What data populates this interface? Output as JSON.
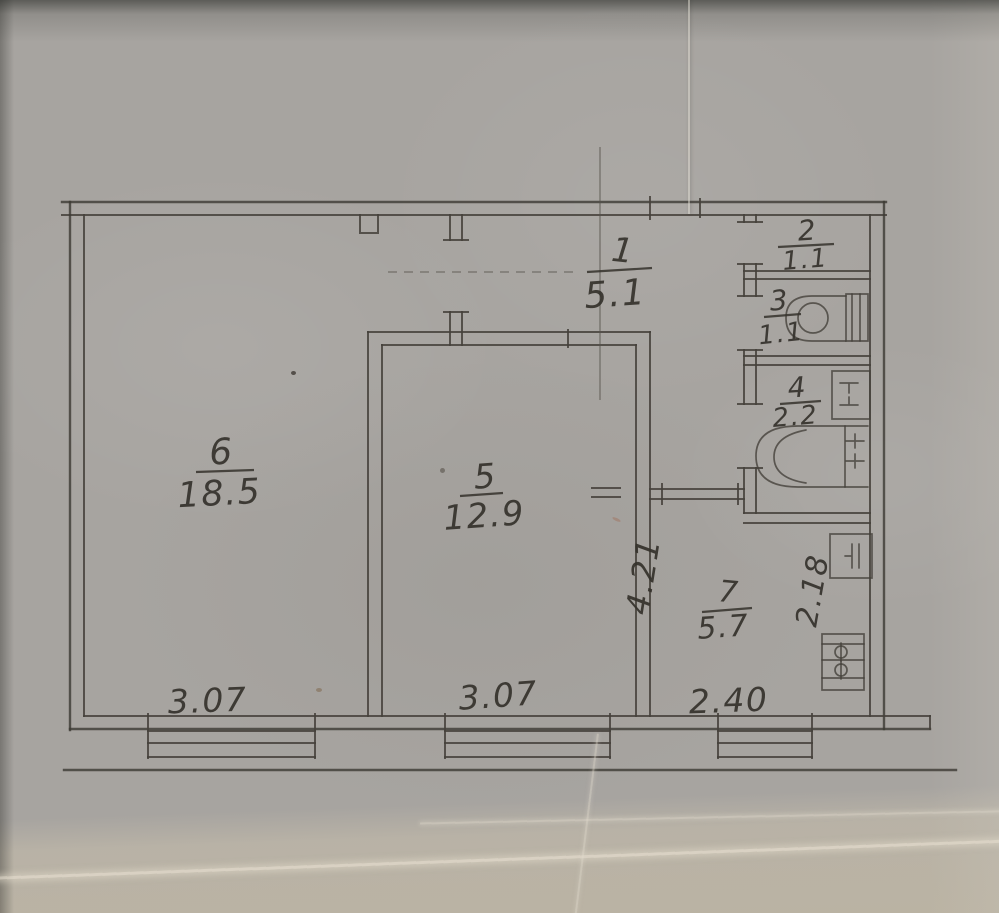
{
  "plan": {
    "title": "apartment-floor-plan",
    "rooms": [
      {
        "number": "1",
        "area": "5.1"
      },
      {
        "number": "2",
        "area": "1.1"
      },
      {
        "number": "3",
        "area": "1.1"
      },
      {
        "number": "4",
        "area": "2.2"
      },
      {
        "number": "5",
        "area": "12.9"
      },
      {
        "number": "6",
        "area": "18.5"
      },
      {
        "number": "7",
        "area": "5.7"
      }
    ],
    "dimensions": {
      "bottom_left": "3.07",
      "bottom_middle": "3.07",
      "bottom_right": "2.40",
      "corridor_vertical": "4.21",
      "kitchen_vertical": "2.18"
    },
    "fixtures": [
      "toilet",
      "washbasin",
      "bathtub",
      "kitchen-sink",
      "stove"
    ],
    "colors": {
      "paper": "#a7a4a0",
      "paper_light": "#c1b8a4",
      "ink": "#45413b"
    }
  }
}
